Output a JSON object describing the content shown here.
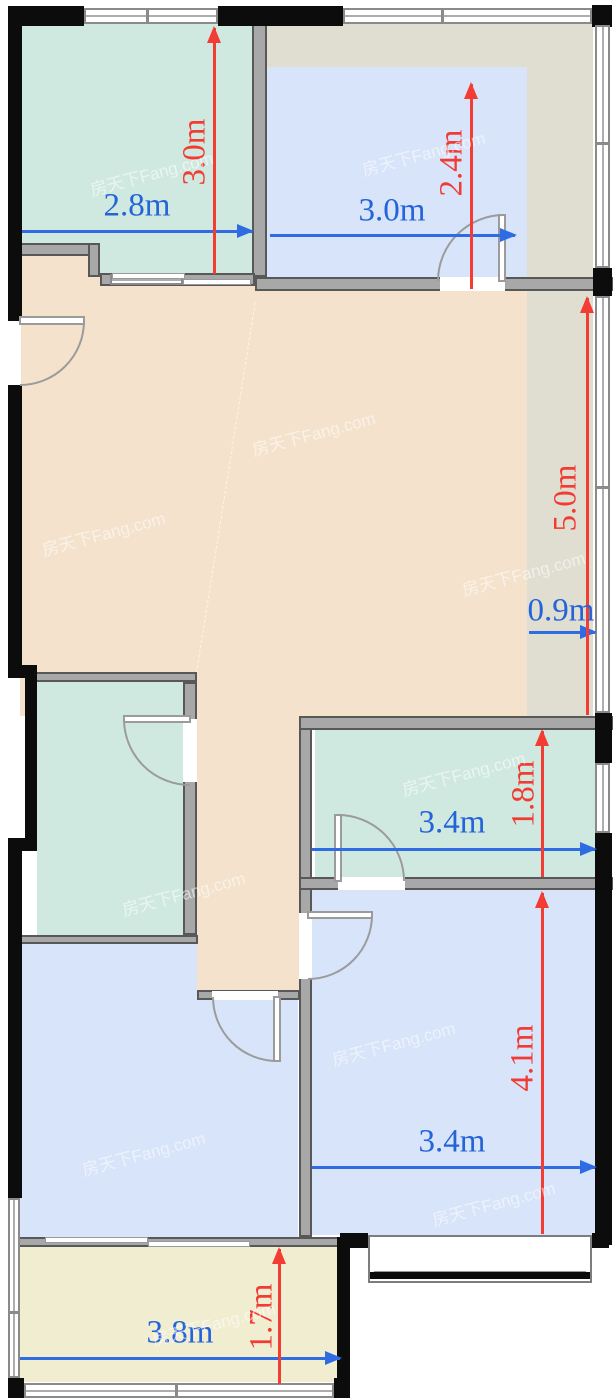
{
  "plan": {
    "watermark_text": "房天下Fang.com",
    "colors": {
      "dim_horizontal": "#2563d9",
      "dim_vertical": "#f13b33",
      "room_teal": "#d0e9e0",
      "room_blue": "#d7e4f9",
      "room_peach": "#f4e2cc",
      "room_cream": "#f0edd1",
      "area_gray_green": "#dfded0",
      "wall_black": "#0c0c0c",
      "wall_gray": "#a8a8a8",
      "window_white": "#ffffff"
    },
    "dimensions": [
      {
        "id": "top-left-room-width",
        "label": "2.8m",
        "axis": "horizontal"
      },
      {
        "id": "top-left-room-depth",
        "label": "3.0m",
        "axis": "vertical"
      },
      {
        "id": "top-right-room-width",
        "label": "3.0m",
        "axis": "horizontal"
      },
      {
        "id": "top-right-room-depth",
        "label": "2.4m",
        "axis": "vertical"
      },
      {
        "id": "east-strip-length",
        "label": "5.0m",
        "axis": "vertical"
      },
      {
        "id": "east-strip-width",
        "label": "0.9m",
        "axis": "horizontal"
      },
      {
        "id": "bathroom-width",
        "label": "3.4m",
        "axis": "horizontal"
      },
      {
        "id": "bathroom-depth",
        "label": "1.8m",
        "axis": "vertical"
      },
      {
        "id": "bedroom-width",
        "label": "3.4m",
        "axis": "horizontal"
      },
      {
        "id": "bedroom-depth",
        "label": "4.1m",
        "axis": "vertical"
      },
      {
        "id": "balcony-width",
        "label": "3.8m",
        "axis": "horizontal"
      },
      {
        "id": "balcony-depth",
        "label": "1.7m",
        "axis": "vertical"
      }
    ]
  }
}
